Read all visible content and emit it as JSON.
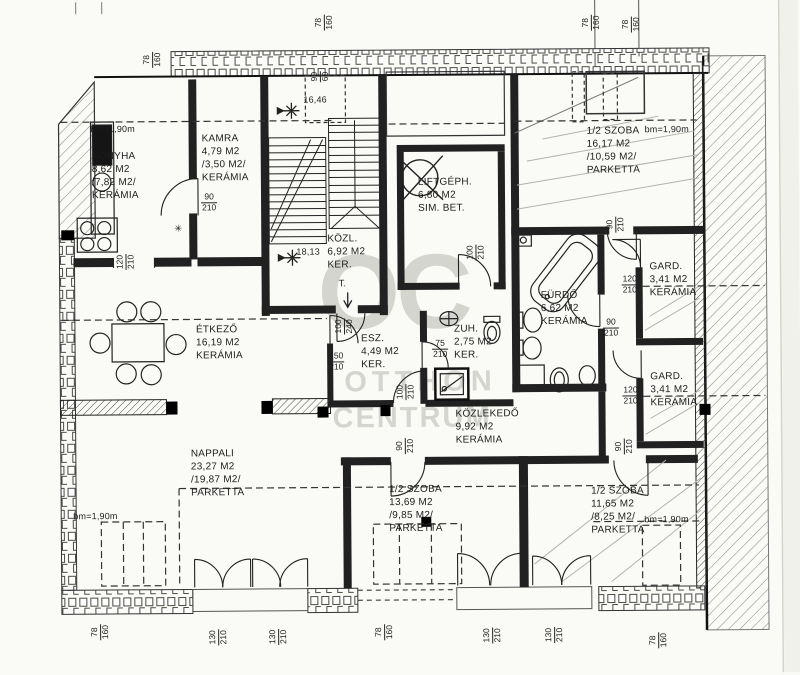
{
  "watermark": {
    "monogram": "OC",
    "name_line1": "OTTHON",
    "name_line2": "CENTRUM"
  },
  "height_limit_label": "bm=1,90m",
  "levels": {
    "landing": "16,46",
    "upper": "18,13"
  },
  "annotations": {
    "trapdoor": "T.",
    "flue_mark": "✳"
  },
  "rooms": [
    {
      "name": "KONYHA",
      "area": "8,62 M2",
      "reduced": "/7,82 M2/",
      "floor": "KERÁMIA"
    },
    {
      "name": "KAMRA",
      "area": "4,79 M2",
      "reduced": "/3,50 M2/",
      "floor": "KERÁMIA"
    },
    {
      "name": "KÖZL.",
      "area": "6,92 M2",
      "floor": "KER."
    },
    {
      "name": "LIFTGÉPH.",
      "area": "6,80 M2",
      "floor": "SIM. BET."
    },
    {
      "name": "1/2 SZOBA",
      "area": "16,17 M2",
      "reduced": "/10,59 M2/",
      "floor": "PARKETTA"
    },
    {
      "name": "FÜRDŐ",
      "area": "6,62 M2",
      "floor": "KERÁMIA"
    },
    {
      "name": "GARD.",
      "area": "3,41 M2",
      "floor": "KERÁMIA"
    },
    {
      "name": "GARD.",
      "area": "3,41 M2",
      "floor": "KERÁMIA"
    },
    {
      "name": "ÉTKEZŐ",
      "area": "16,19 M2",
      "floor": "KERÁMIA"
    },
    {
      "name": "ESZ.",
      "area": "4,49 M2",
      "floor": "KER."
    },
    {
      "name": "ZUH.",
      "area": "2,75 M2",
      "floor": "KER."
    },
    {
      "name": "KÖZLEKEDŐ",
      "area": "9,92 M2",
      "floor": "KERÁMIA"
    },
    {
      "name": "NAPPALI",
      "area": "23,27 M2",
      "reduced": "/19,87 M2/",
      "floor": "PARKETTA"
    },
    {
      "name": "1/2 SZOBA",
      "area": "13,69 M2",
      "reduced": "/9,85 M2/",
      "floor": "PARKETTA"
    },
    {
      "name": "1/2 SZOBA",
      "area": "11,65 M2",
      "reduced": "/8,25 M2/",
      "floor": "PARKETTA"
    }
  ],
  "dims": [
    {
      "w": "78",
      "h": "160"
    },
    {
      "w": "78",
      "h": "160"
    },
    {
      "w": "78",
      "h": "160"
    },
    {
      "w": "78",
      "h": "160"
    },
    {
      "w": "90",
      "h": "210"
    },
    {
      "w": "120",
      "h": "210"
    },
    {
      "w": "100",
      "h": "210"
    },
    {
      "w": "90",
      "h": "210"
    },
    {
      "w": "120",
      "h": "210"
    },
    {
      "w": "120",
      "h": "210"
    },
    {
      "w": "90",
      "h": "210"
    },
    {
      "w": "150",
      "h": "210"
    },
    {
      "w": "100",
      "h": "240"
    },
    {
      "w": "100",
      "h": "210"
    },
    {
      "w": "75",
      "h": "210"
    },
    {
      "w": "90",
      "h": "210"
    },
    {
      "w": "90",
      "h": "210"
    },
    {
      "w": "78",
      "h": "160"
    },
    {
      "w": "130",
      "h": "210"
    },
    {
      "w": "130",
      "h": "210"
    },
    {
      "w": "78",
      "h": "160"
    },
    {
      "w": "130",
      "h": "210"
    },
    {
      "w": "130",
      "h": "210"
    },
    {
      "w": "78",
      "h": "160"
    },
    {
      "w": "90",
      "h": "60"
    }
  ]
}
